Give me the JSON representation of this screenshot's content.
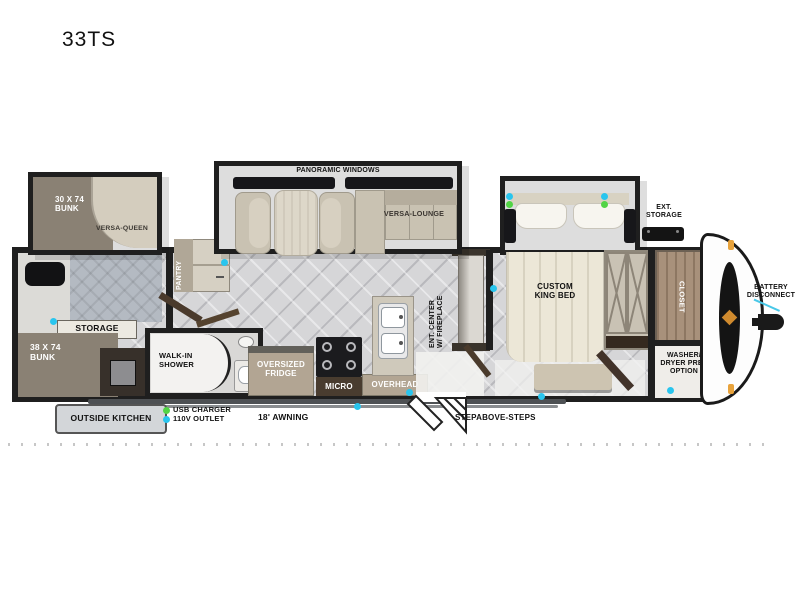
{
  "title": "33TS",
  "floorplan": {
    "slide_bunk": {
      "bunk": "30 X 74\nBUNK",
      "sofa": "VERSA-QUEEN"
    },
    "slide_main": {
      "band": "PANORAMIC WINDOWS",
      "sofa": "VERSA-LOUNGE"
    },
    "slide_bed": {
      "bed": "CUSTOM\nKING BED"
    },
    "pantry": "PANTRY",
    "storage": "STORAGE",
    "bunk38": "38 X 74\nBUNK",
    "shower": "WALK-IN\nSHOWER",
    "fridge": "OVERSIZED\nFRIDGE",
    "micro": "MICRO",
    "overhead": "OVERHEAD",
    "ent_center": "ENT. CENTER\nW/ FIREPLACE",
    "closet": "CLOSET",
    "washer": "WASHER/\nDRYER PREP\nOPTION"
  },
  "exterior": {
    "outside_kitchen": "OUTSIDE KITCHEN",
    "awning": "18' AWNING",
    "steps": "STEPABOVE-STEPS",
    "ext_storage": "EXT.\nSTORAGE",
    "battery": "BATTERY\nDISCONNECT"
  },
  "legend": {
    "usb": {
      "label": "USB CHARGER",
      "color": "#52d445"
    },
    "outlet": {
      "label": "110V OUTLET",
      "color": "#29c5ee"
    }
  },
  "colors": {
    "wall": "#1f1f1f",
    "floor": "#d6d6d8",
    "furniture": "#c9c2b2",
    "emblem_orange": "#cf8a2e",
    "battery_line": "#49c8e8"
  }
}
